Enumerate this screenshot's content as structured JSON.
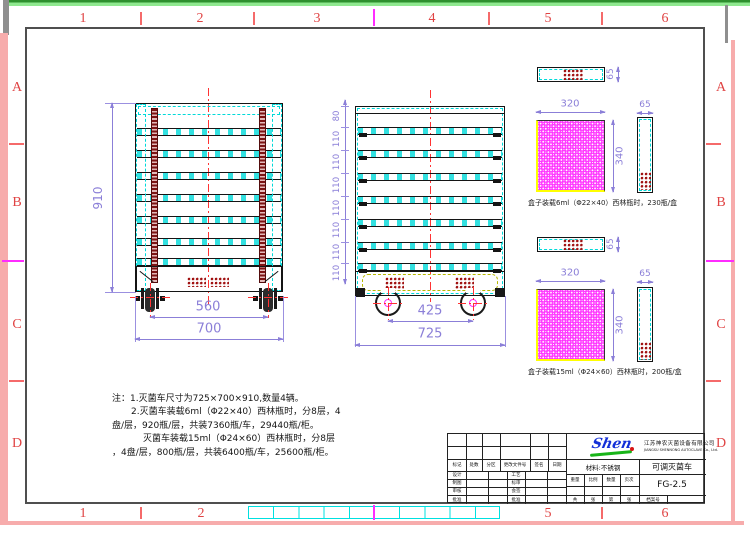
{
  "sheet": {
    "zones": {
      "top": [
        "1",
        "2",
        "3",
        "4",
        "5",
        "6"
      ],
      "bottom": [
        "1",
        "2",
        "5",
        "6"
      ],
      "left": [
        "A",
        "B",
        "C",
        "D"
      ],
      "right": [
        "A",
        "B",
        "C",
        "D"
      ]
    },
    "colors": {
      "frame_gray": "#4f4f4f",
      "zone_red": "#e04343",
      "dim_purple": "#8b7fd8",
      "cad_cyan": "#00d9d9",
      "magenta": "#ff2cff",
      "dark_red_vials": "#a01010",
      "tray_yellow": "#ffff00",
      "edge_green": "#6cd96c",
      "edge_pink": "#f7acac",
      "centerline_red": "#ff3333"
    }
  },
  "front_view": {
    "height": "910",
    "wheelbase": "560",
    "width": "700"
  },
  "side_view": {
    "chain": [
      "80",
      "110",
      "110",
      "110",
      "110",
      "110",
      "110",
      "110"
    ],
    "wheelbase": "425",
    "depth": "725"
  },
  "trays": {
    "t6": {
      "w": "320",
      "h": "340",
      "d1": "65",
      "d2": "65",
      "caption": "盒子装载6ml（Φ22×40）西林瓶时，230瓶/盒"
    },
    "t15": {
      "w": "320",
      "h": "340",
      "d1": "65",
      "d2": "65",
      "caption": "盒子装载15ml（Φ24×60）西林瓶时，200瓶/盒"
    }
  },
  "notes": {
    "l1": "注：1.灭菌车尺寸为725×700×910,数量4辆。",
    "l2": "2.灭菌车装载6ml（Φ22×40）西林瓶时，分8层，4",
    "l3": "盘/层，920瓶/层，共装7360瓶/车，29440瓶/柜。",
    "l4": "灭菌车装载15ml（Φ24×60）西林瓶时，分8层",
    "l5": "，4盘/层，800瓶/层，共装6400瓶/车，25600瓶/柜。"
  },
  "title_block": {
    "rev": [
      "标记",
      "处数",
      "分区",
      "更改文件号",
      "签名",
      "日期"
    ],
    "c1": [
      "设计",
      "制图",
      "审核",
      "批准"
    ],
    "c2": [
      "工艺",
      "标审",
      "会签",
      "批准"
    ],
    "material": "材料:不锈钢",
    "product": "可调灭菌车",
    "drawing_no": "FG-2.5",
    "qty": [
      "重量",
      "比例",
      "数量",
      "页次"
    ],
    "sheetrow": [
      "共",
      "张",
      "第",
      "张"
    ],
    "archive": "档案号",
    "logo": "Shen",
    "company_cn": "江苏神农灭菌设备有限公司",
    "company_en": "JIANGSU SHENNONG AUTOCLAVE Co., Ltd."
  }
}
